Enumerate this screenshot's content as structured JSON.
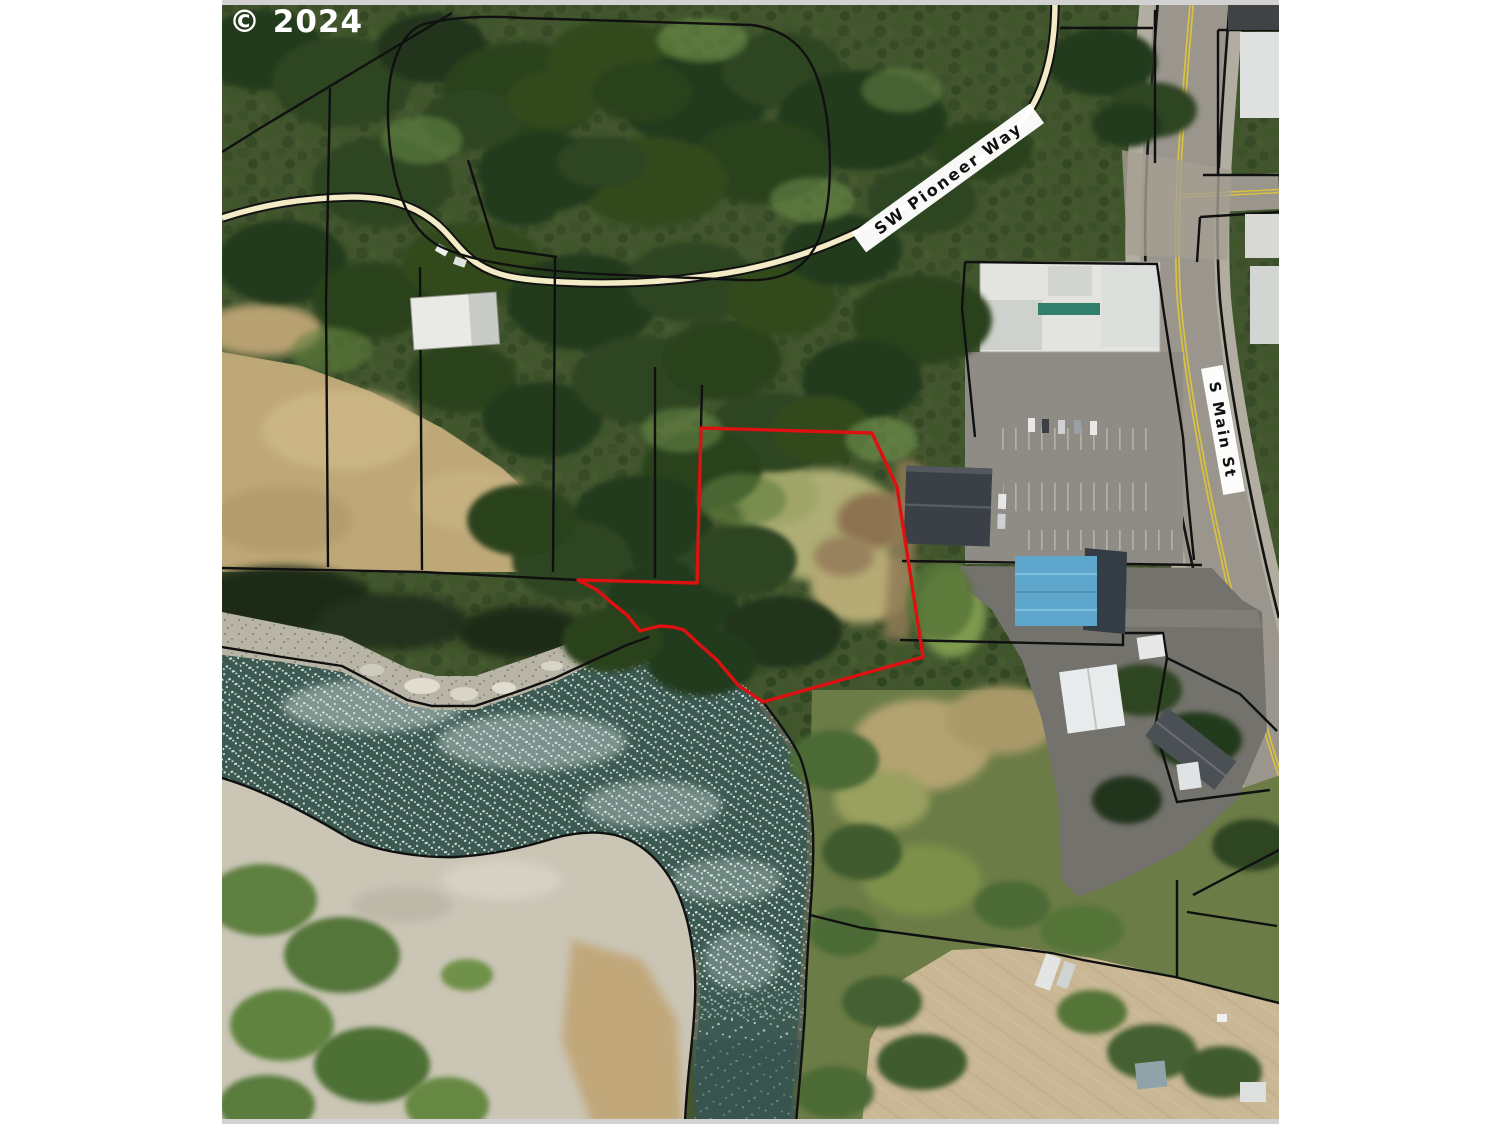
{
  "canvas": {
    "width": 1505,
    "height": 1129,
    "background": "#ffffff"
  },
  "map": {
    "type": "aerial-parcel-map",
    "copyright": "© 2024",
    "labels": {
      "road1": "SW Pioneer Way",
      "road2": "S Main St"
    },
    "colors": {
      "subject_parcel_outline": "#dd1111",
      "parcel_boundary": "#101010",
      "forest": "#42552e",
      "grass_tan": "#bfa878",
      "water": "#3c5a52",
      "gravel_bar": "#cac5b5",
      "road_fill": "#f2ebc6",
      "pavement": "#9a958d",
      "centerline_yellow": "#d9c33e",
      "blue_roof": "#5ea6cb",
      "frame_border": "#d2d2d2"
    }
  }
}
